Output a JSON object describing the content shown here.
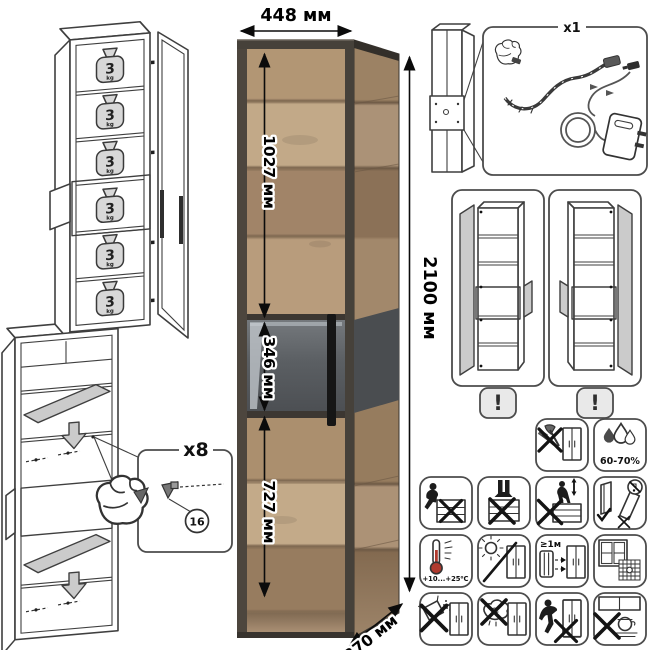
{
  "dimensions": {
    "width_label": "448 мм",
    "height_label": "2100 мм",
    "depth_label": "370 мм",
    "upper_door_label": "1027 мм",
    "display_section_label": "346 мм",
    "lower_door_label": "727 мм"
  },
  "shelf_load": {
    "value": "3",
    "unit": "kg"
  },
  "led_kit": {
    "count_label": "x1"
  },
  "shelf_supports": {
    "count_label": "x8",
    "part_number": "16"
  },
  "door_reversibility": {
    "warning_symbol": "!"
  },
  "care_instructions": {
    "humidity_range": "60-70%",
    "temperature_range": "+10...+25⁰C",
    "heater_distance": "≥1м"
  },
  "colors": {
    "wood": "#b19574",
    "frame": "#46413a",
    "glass": "#54575b",
    "outline": "#3f3f3f",
    "shelf_gray": "#cbcbcb",
    "thermometer_red": "#b03a2e"
  },
  "icon_names": [
    "no-impact-tools",
    "humidity-60-70",
    "no-sitting",
    "no-standing",
    "no-climbing",
    "transport-upright-only",
    "temperature-range",
    "no-direct-sunlight",
    "keep-distance-from-heater",
    "ventilate-room",
    "no-abrasive-cleaners",
    "no-wet-cloth",
    "no-dragging",
    "keep-away-from-stove"
  ]
}
